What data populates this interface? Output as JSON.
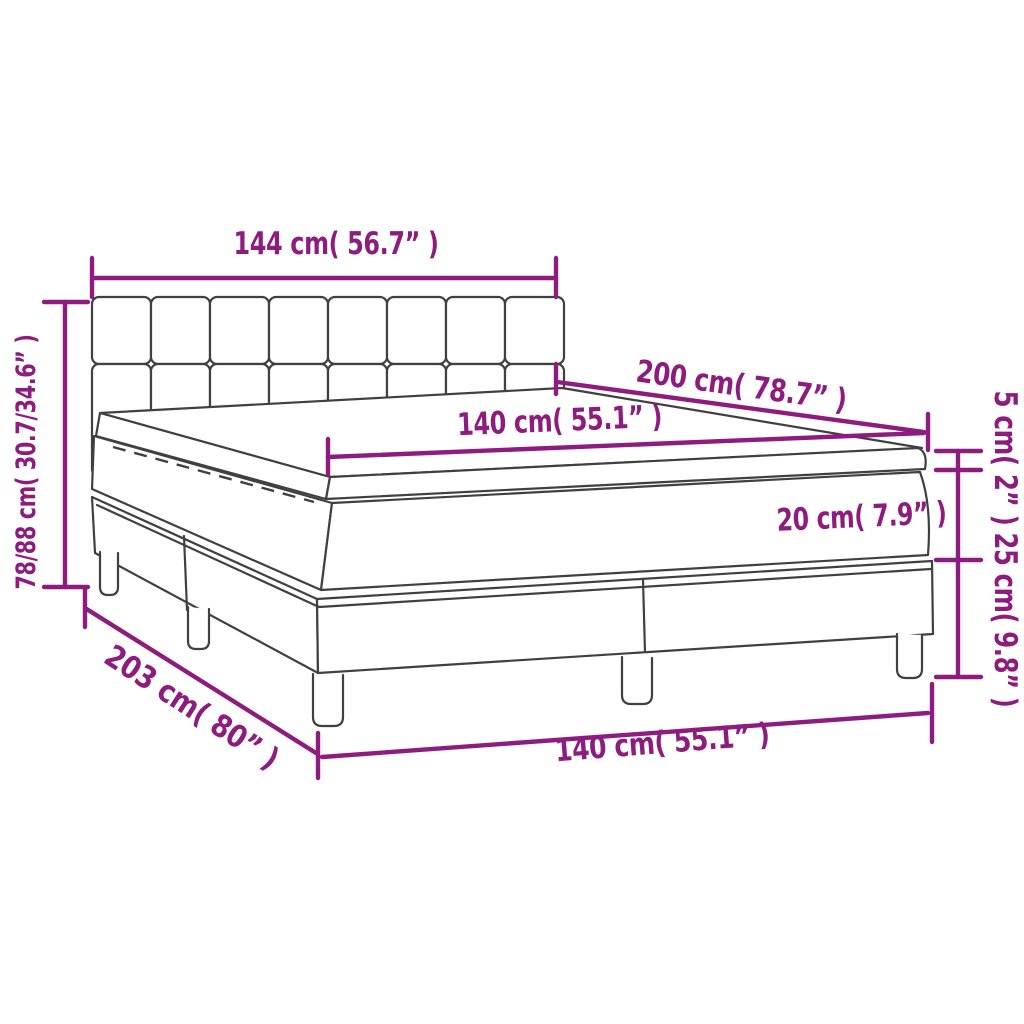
{
  "diagram": {
    "title": "Box spring bed with mattress and topper — dimension diagram",
    "background": "#FFFFFF",
    "line_color": "#404040",
    "accent_color": "#8E1C7E",
    "annotations": {
      "headboard_width": "144 cm( 56.7” )",
      "bed_length": "200 cm( 78.7” )",
      "mattress_width": "140 cm( 55.1” )",
      "total_height": "78/88 cm( 30.7/34.6” )",
      "topper_height": "5 cm( 2” )",
      "mattress_height": "20 cm( 7.9” )",
      "base_height": "25 cm( 9.8” )",
      "base_length": "203 cm( 80” )",
      "base_width": "140 cm( 55.1” )"
    }
  }
}
